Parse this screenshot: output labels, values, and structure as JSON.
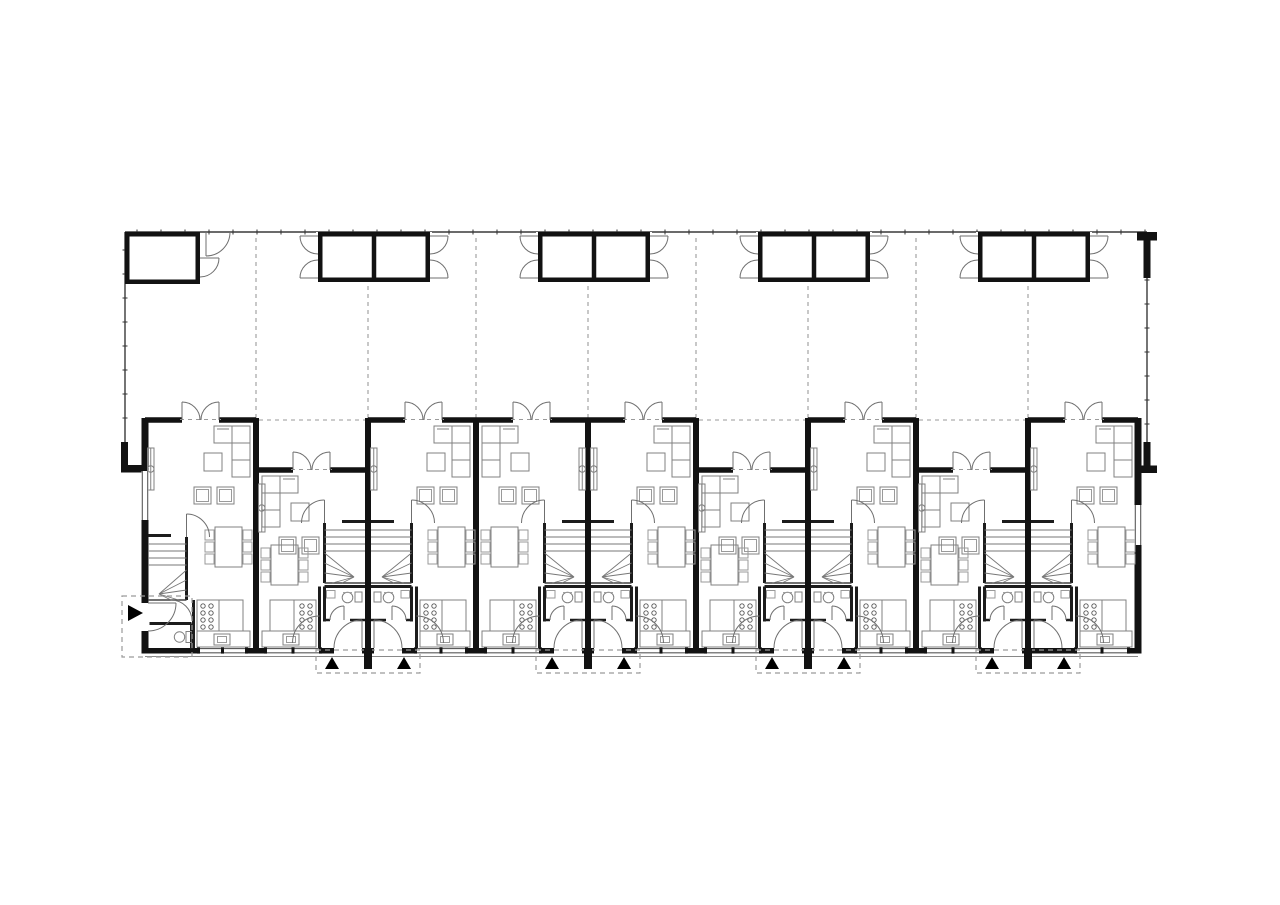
{
  "page": {
    "background": "#ffffff"
  },
  "drawing": {
    "type": "architectural-floor-plan",
    "description": "Ground floor plan of a row of nine terraced houses with back gardens, garden sheds along the rear boundary, shared entrance porches marked with black triangles, and an end-unit side entrance marked with a black arrow",
    "canvas": {
      "width": 1280,
      "height": 905
    },
    "colors": {
      "background": "#ffffff",
      "wall": "#121212",
      "thin_wall": "#1c1c1c",
      "fence": "#3a3a3a",
      "furniture": "#808080",
      "furniture_light": "#9a9a9a",
      "door": "#6f6f6f",
      "dash": "#9a9a9a",
      "window": "#5a5a5a",
      "marker": "#000000"
    },
    "site": {
      "fence_top_y": 232,
      "fence_left_x": 125,
      "fence_right_x": 1147,
      "fence_bottom_left_y": 442,
      "fence_bottom_right_y": 442,
      "tick_spacing": 24
    },
    "row": {
      "top_y": 420,
      "setback_top_y": 470,
      "bottom_y": 648,
      "wall_thickness": 6,
      "unit_edges": [
        145,
        256,
        368,
        476,
        588,
        696,
        808,
        916,
        1028,
        1138
      ],
      "garden_door_offset": 37,
      "garden_door_width": 37
    },
    "units": [
      {
        "id": "house-1",
        "hand": "left",
        "setback": false,
        "end": "left"
      },
      {
        "id": "house-2",
        "hand": "right",
        "setback": true,
        "end": null
      },
      {
        "id": "house-3",
        "hand": "left",
        "setback": false,
        "end": null
      },
      {
        "id": "house-4",
        "hand": "right",
        "setback": false,
        "end": null
      },
      {
        "id": "house-5",
        "hand": "left",
        "setback": false,
        "end": null
      },
      {
        "id": "house-6",
        "hand": "right",
        "setback": true,
        "end": null
      },
      {
        "id": "house-7",
        "hand": "left",
        "setback": false,
        "end": null
      },
      {
        "id": "house-8",
        "hand": "right",
        "setback": true,
        "end": null
      },
      {
        "id": "house-9",
        "hand": "left",
        "setback": false,
        "end": "right"
      }
    ],
    "sheds": {
      "corner_shed": {
        "x": 125,
        "y": 232,
        "w": 75,
        "h": 52
      },
      "pair_centers_x": [
        374,
        594,
        814,
        1034
      ],
      "pair_box_w": 56,
      "pair_h": 50
    },
    "garden_dividers_x": [
      256,
      368,
      476,
      588,
      696,
      808,
      916,
      1028
    ],
    "porches": {
      "pair_centers_x": [
        368,
        588,
        808,
        1028
      ],
      "rect_half_w": 52,
      "rect_top_y": 650,
      "rect_bottom_y": 673,
      "triangle_offset_x": 36,
      "side_porch": {
        "x": 122,
        "y": 596,
        "w": 70,
        "h": 61
      }
    },
    "interior": {
      "stair_zone_y": [
        523,
        583
      ],
      "bath_zone_y": [
        587,
        620
      ],
      "hall_zone_y": [
        620,
        648
      ],
      "kitchen_y": 600,
      "dining_y": 527,
      "dining_setback_shift": 18
    }
  }
}
